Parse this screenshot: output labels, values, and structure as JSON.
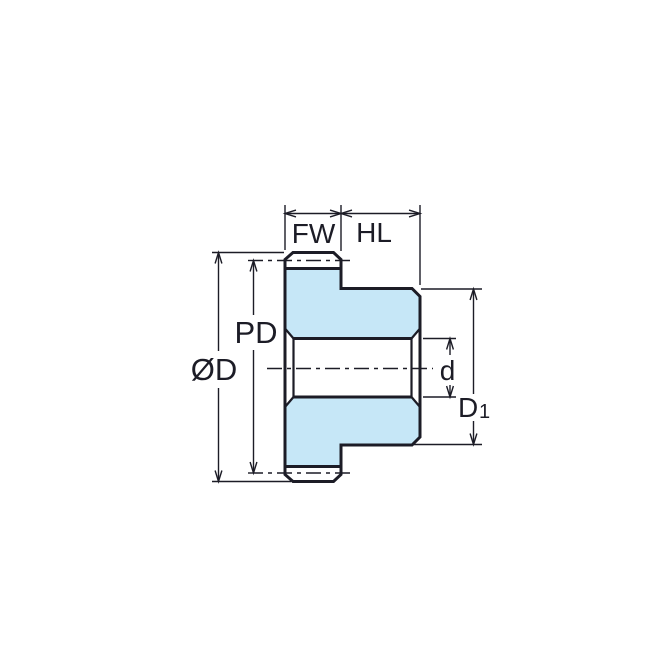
{
  "diagram": {
    "kind": "spur-gear-cross-section-dimension-drawing",
    "labels": {
      "face_width": "FW",
      "hub_length": "HL",
      "pitch_diameter": "PD",
      "outside_diameter": "ØD",
      "bore_diameter": "d",
      "hub_diameter_base": "D",
      "hub_diameter_sub": "1"
    },
    "colors": {
      "outline": "#1c1c26",
      "gear_fill": "#c6e7f7",
      "background": "#ffffff"
    }
  }
}
